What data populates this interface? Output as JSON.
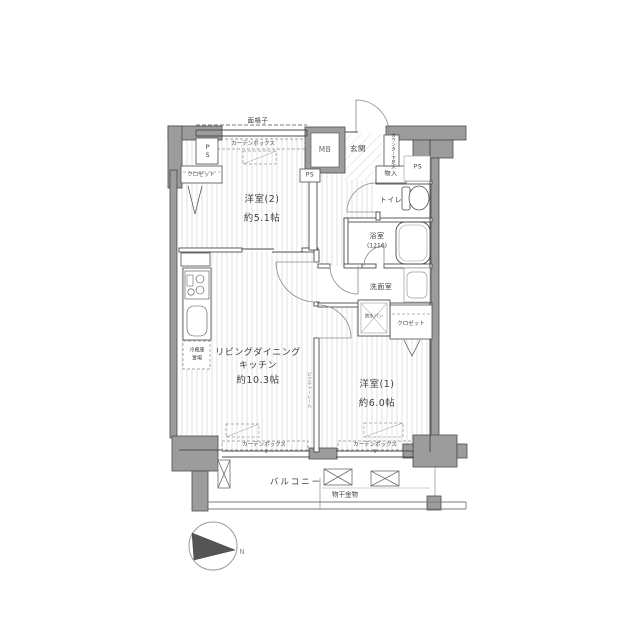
{
  "floorplan": {
    "rooms": {
      "western2": {
        "name": "洋室(2)",
        "area": "約5.1帖"
      },
      "ldk": {
        "name_line1": "リビングダイニング",
        "name_line2": "キッチン",
        "area": "約10.3帖"
      },
      "western1": {
        "name": "洋室(1)",
        "area": "約6.0帖"
      },
      "entrance": {
        "name": "玄関"
      },
      "toilet": {
        "name": "トイレ"
      },
      "bathroom": {
        "name": "浴室",
        "size": "(1216)"
      },
      "washroom": {
        "name": "洗面室"
      },
      "balcony": {
        "name": "バルコニー"
      }
    },
    "fixtures": {
      "meter_box": "MB",
      "pipe_space": "PS",
      "closet": "クロゼット",
      "storage": "物入",
      "shoe_counter": "カウンター下足入",
      "curtain_box": "カーテンボックス",
      "window_grille": "面格子",
      "waterproof_pan": "防水パン",
      "fridge_line1": "冷蔵庫",
      "fridge_line2": "置場",
      "picture_rail": "ピクチャーレール",
      "laundry_hardware": "物干金物",
      "compass_north": "N"
    },
    "colors": {
      "wall": "#9c9c9c",
      "outline": "#4b4b4b",
      "floor_stripe": "#e1e1e5"
    }
  }
}
